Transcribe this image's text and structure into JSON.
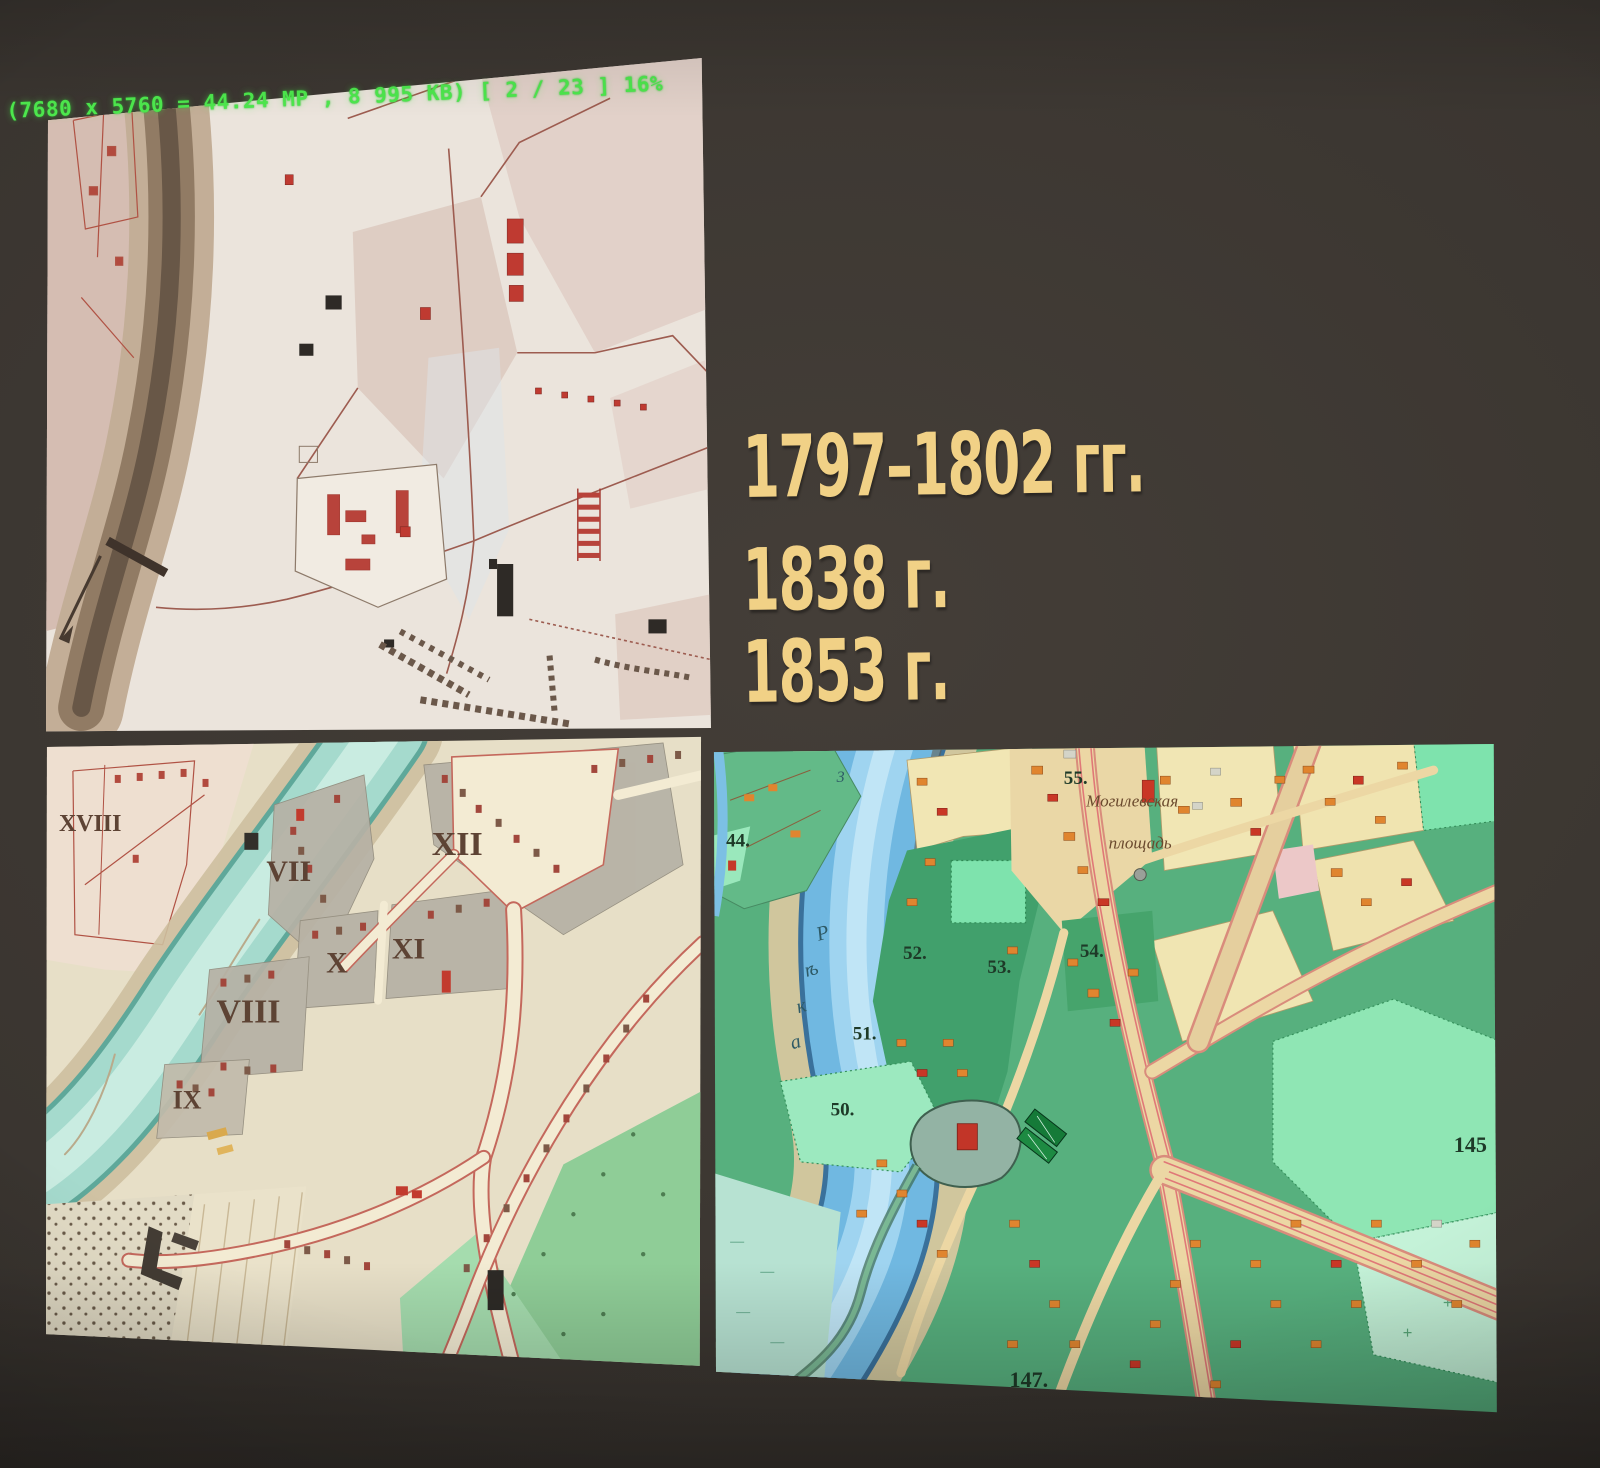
{
  "viewer": {
    "status_text": "(7680 x 5760 = 44.24 MP , 8 995 KB) [ 2 / 23 ] 16%",
    "status_color": "#4de84d"
  },
  "slide": {
    "years": [
      "1797–1802 гг.",
      "1838 г.",
      "1853 г."
    ],
    "year_color": "#f1d186",
    "background_color": "#3a3530"
  },
  "map_1838": {
    "district_numerals": [
      "XVIII",
      "VII",
      "XII",
      "X",
      "XI",
      "VIII",
      "IX"
    ]
  },
  "map_1853": {
    "parcel_numbers": [
      "44.",
      "50.",
      "51.",
      "52.",
      "53.",
      "54.",
      "55.",
      "145",
      "147."
    ],
    "square_name_line1": "Могилевская",
    "square_name_line2": "площадь",
    "river_letters": [
      "Р",
      "ѣ",
      "к",
      "а"
    ],
    "river_mark": "3"
  }
}
